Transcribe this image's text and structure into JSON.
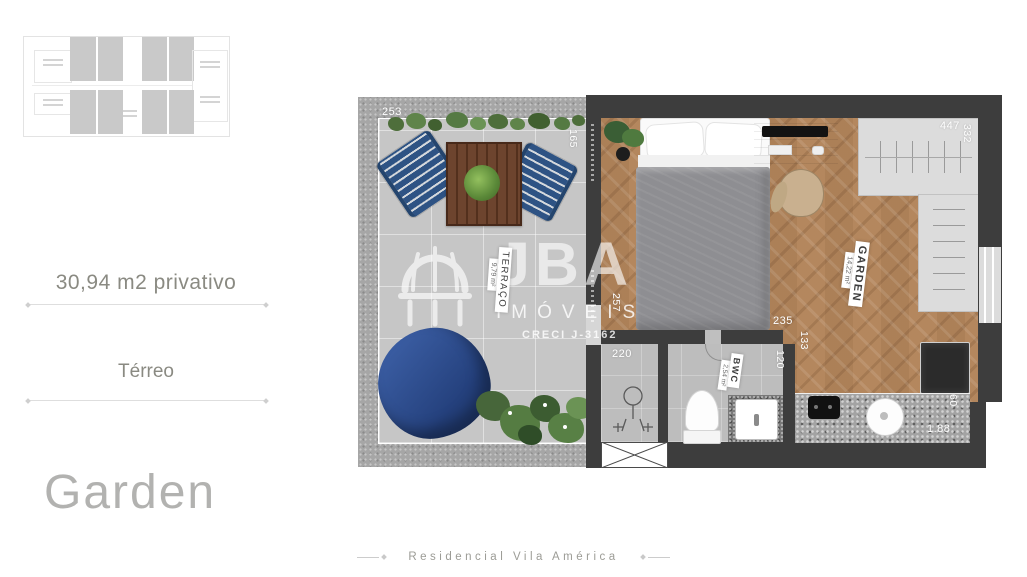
{
  "sidebar": {
    "area_label": "30,94 m2 privativo",
    "floor_label": "Térreo",
    "unit_title": "Garden"
  },
  "footer": {
    "brand": "Residencial Vila América"
  },
  "watermark": {
    "brand": "JBA",
    "division": "IMÓVEIS",
    "license": "CRECI J-3162"
  },
  "plan": {
    "rooms": {
      "terraco": {
        "name": "TERRAÇO",
        "area": "9,79 m²"
      },
      "garden": {
        "name": "GARDEN",
        "area": "14,22 m²"
      },
      "bwc": {
        "name": "BWC",
        "area": "2,54 m²"
      }
    },
    "dims": {
      "d253": "253",
      "d165": "165",
      "d447": "447",
      "d332": "332",
      "d257": "257",
      "d235": "235",
      "d220": "220",
      "d120": "120",
      "d133": "133",
      "d60": "60",
      "d188": "1.88"
    }
  },
  "icons": {
    "watermark_logo": "gazebo-dome-icon",
    "mini_plan": "unit-location-thumbnail"
  },
  "colors": {
    "wall": "#3d3d3d",
    "wood_floor": "#b5885f",
    "terrace_floor": "#c6c6c6",
    "bath_floor": "#bdbdbd",
    "accent_blue": "#2e4e8e",
    "plant_green": "#557a43",
    "sidebar_text": "#8a8a82",
    "title_text": "#b2b2b0",
    "dimension_text": "#ffffff"
  }
}
